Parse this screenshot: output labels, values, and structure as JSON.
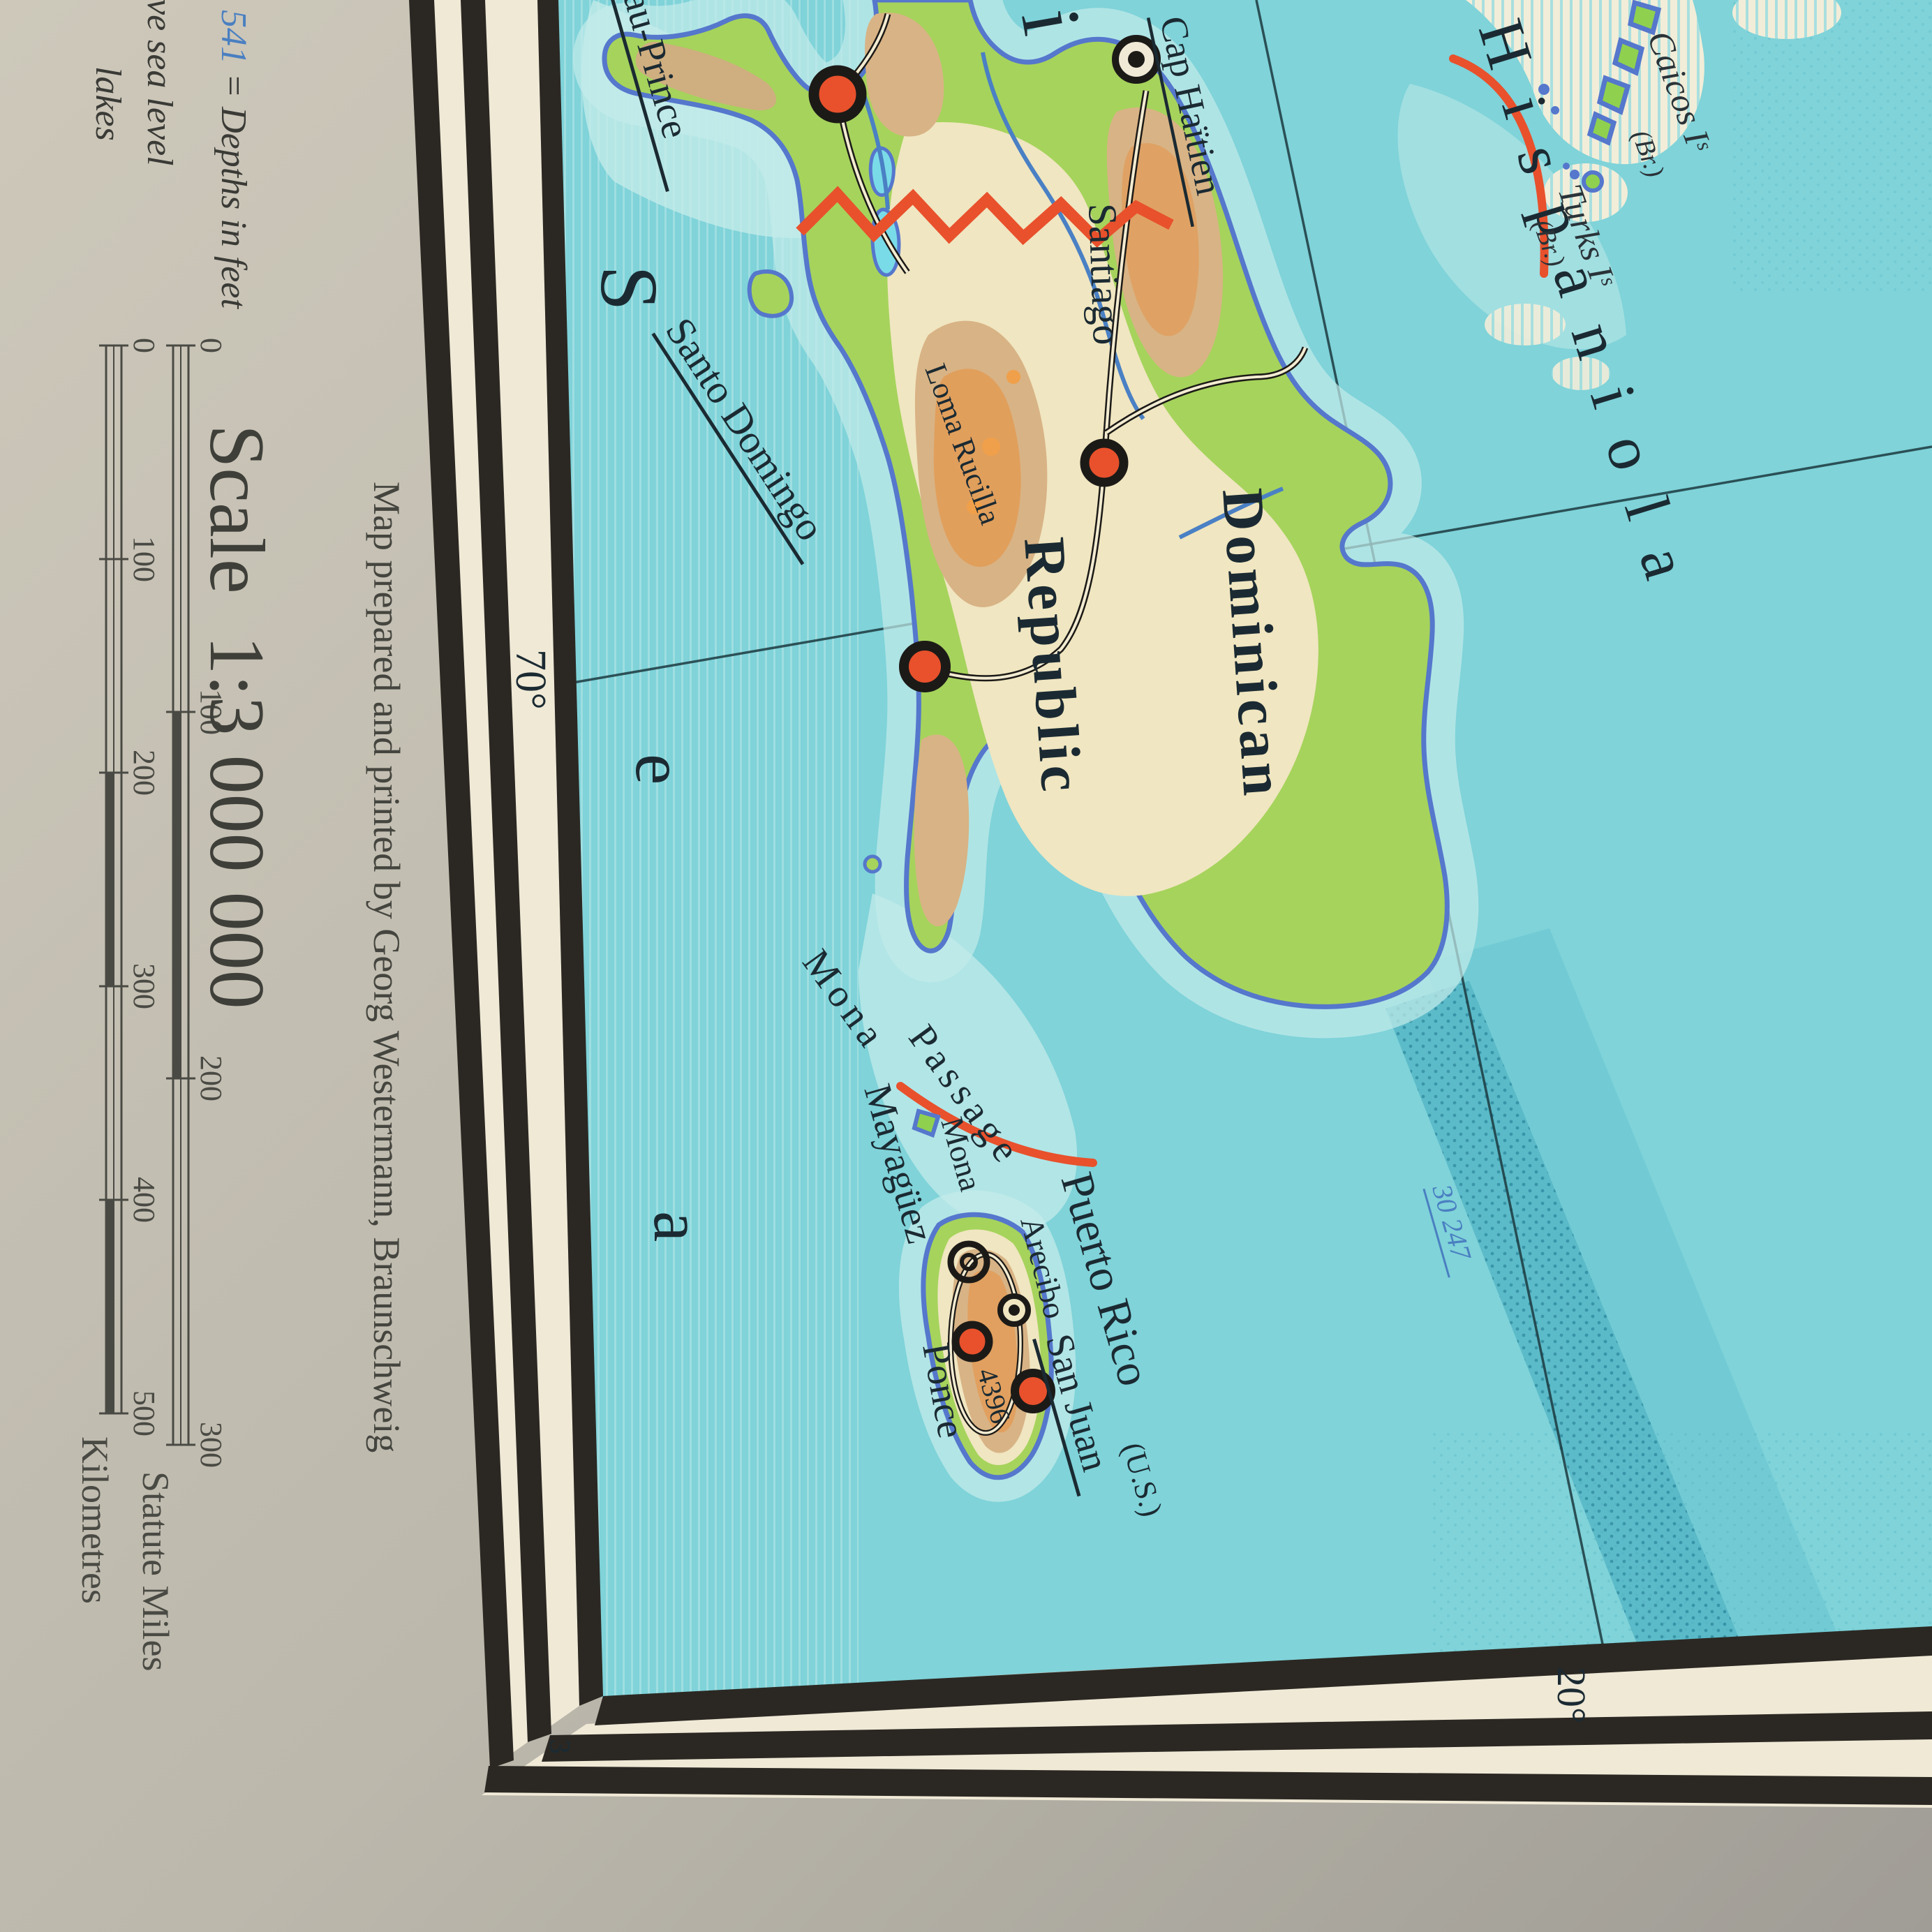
{
  "photo": {
    "margin_color_light": "#cdc8ba",
    "margin_color_dark": "#a09d96",
    "sheet_cream": "#efe9d6",
    "frame_black": "#2b2823"
  },
  "legend": {
    "depth_value": "2 541",
    "depth_text": " = Depths in feet",
    "height_text": "above sea level",
    "lakes_text": "lakes"
  },
  "scale": {
    "heading_word": "Scale",
    "heading_ratio": "1:3 000 000",
    "imprint": "Map prepared and printed by Georg Westermann, Braunschweig",
    "sheet_number": "3",
    "bars": {
      "miles": {
        "label": "Statute Miles",
        "ticks": [
          "0",
          "100",
          "200",
          "300"
        ]
      },
      "km": {
        "label": "Kilometres",
        "ticks": [
          "0",
          "100",
          "200",
          "300",
          "400",
          "500"
        ]
      }
    }
  },
  "graticule": {
    "lon_label": "70°",
    "lat_label": "20°"
  },
  "sea_word": {
    "s": "S",
    "e": "e",
    "a": "a"
  },
  "labels": {
    "hispaniola": "Hispaniola",
    "haiti_fragment": "ti",
    "dominican": "Dominican",
    "republic": "Republic",
    "port_au_prince": "au-Prince",
    "cap_haitien": "Cap Haïtien",
    "santiago": "Santiago",
    "santo_domingo": "Santo Domingo",
    "loma_rucilla": "Loma Rucilla",
    "loma_rucilla_elev": "10 305",
    "mona_word1": "Mona",
    "mona_word2": "Passage",
    "mona_island": "Mona",
    "puerto_rico": "Puerto Rico",
    "puerto_rico_us": "(U.S.)",
    "san_juan": "San Juan",
    "arecibo": "Arecibo",
    "ponce": "Ponce",
    "mayaguez": "Mayagüez",
    "pr_elev": "4396",
    "caicos": "Caicos Iˢ",
    "caicos_br": "(Br.)",
    "turks": "Turks Iˢ",
    "turks_br": "(Br.)",
    "depth_30247": "30 247"
  },
  "map_colors": {
    "sea": "#7fd3d9",
    "shallow": "#c3ebe9",
    "bank_cream": "#f2edd8",
    "deep_band": "#56b7c6",
    "land_green": "#a6d35c",
    "plain": "#f0e6c1",
    "mountain_tan": "#d8b385",
    "mountain_orange": "#e39b55",
    "coast_blue": "#5577cc",
    "river_blue": "#4a80c4",
    "boundary_red": "#e8512c",
    "lake_cyan": "#7adbe8"
  },
  "symbols": [
    {
      "name": "Port-au-Prince",
      "type": "capital-circle"
    },
    {
      "name": "Santo Domingo",
      "type": "capital-circle"
    },
    {
      "name": "Santiago",
      "type": "city-circle"
    },
    {
      "name": "San Juan",
      "type": "capital-circle"
    },
    {
      "name": "Ponce",
      "type": "city-circle"
    },
    {
      "name": "Cap Haïtien",
      "type": "ring-dot"
    },
    {
      "name": "Arecibo",
      "type": "ring-dot"
    },
    {
      "name": "Mayagüez",
      "type": "double-ring"
    }
  ]
}
